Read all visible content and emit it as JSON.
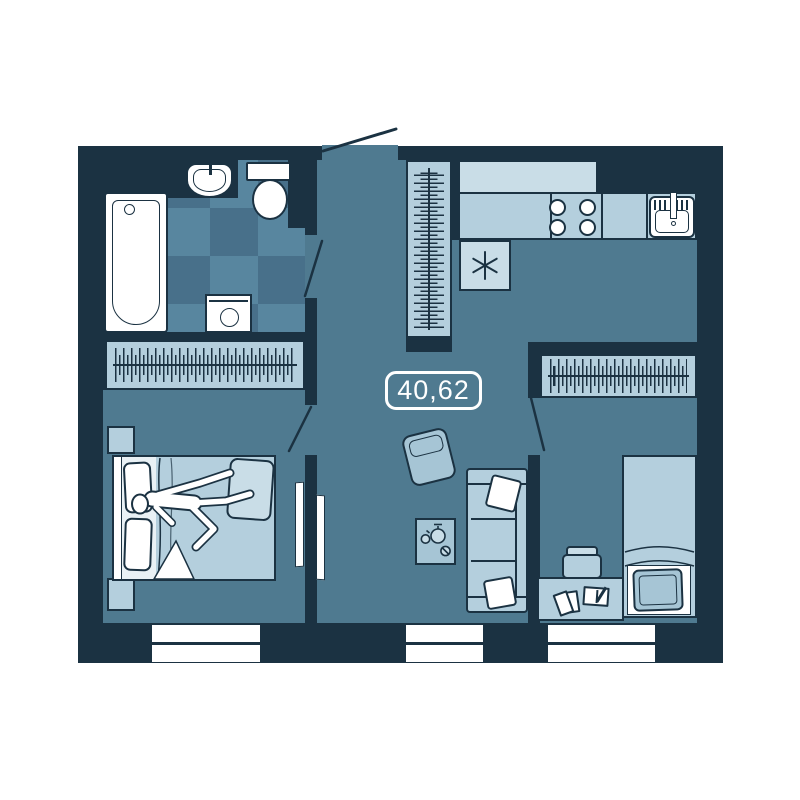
{
  "floor_plan": {
    "area_label": "40,62",
    "colors": {
      "wall": "#1b3242",
      "floor": "#4f7a90",
      "light": "#b4cfdd",
      "lighter": "#c9dde7",
      "mid": "#a6c5d5",
      "tile_light": "#58869f",
      "tile_dark": "#48708a",
      "sheet": "#e9f1f5",
      "white": "#ffffff"
    }
  }
}
